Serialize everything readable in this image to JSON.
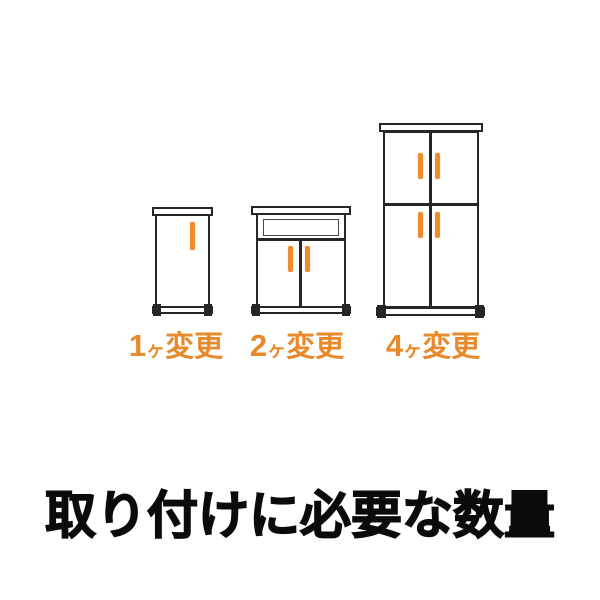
{
  "page": {
    "background": "#ffffff"
  },
  "colors": {
    "outline": "#262626",
    "handle_orange": "#EF8C2E",
    "label_orange": "#E8892B",
    "title_black": "#0b0b0b"
  },
  "heading": {
    "text": "取り付けに必要な数量"
  },
  "cabinets": [
    {
      "name": "single-door-cabinet",
      "doors": 1,
      "handles": 1,
      "count": "1",
      "counter": "ヶ",
      "suffix": "変更",
      "label": "1ヶ変更"
    },
    {
      "name": "double-door-cabinet-with-open-shelf",
      "doors": 2,
      "handles": 2,
      "count": "2",
      "counter": "ヶ",
      "suffix": "変更",
      "label": "2ヶ変更"
    },
    {
      "name": "four-door-tall-cabinet",
      "doors": 4,
      "handles": 4,
      "count": "4",
      "counter": "ヶ",
      "suffix": "変更",
      "label": "4ヶ変更"
    }
  ]
}
